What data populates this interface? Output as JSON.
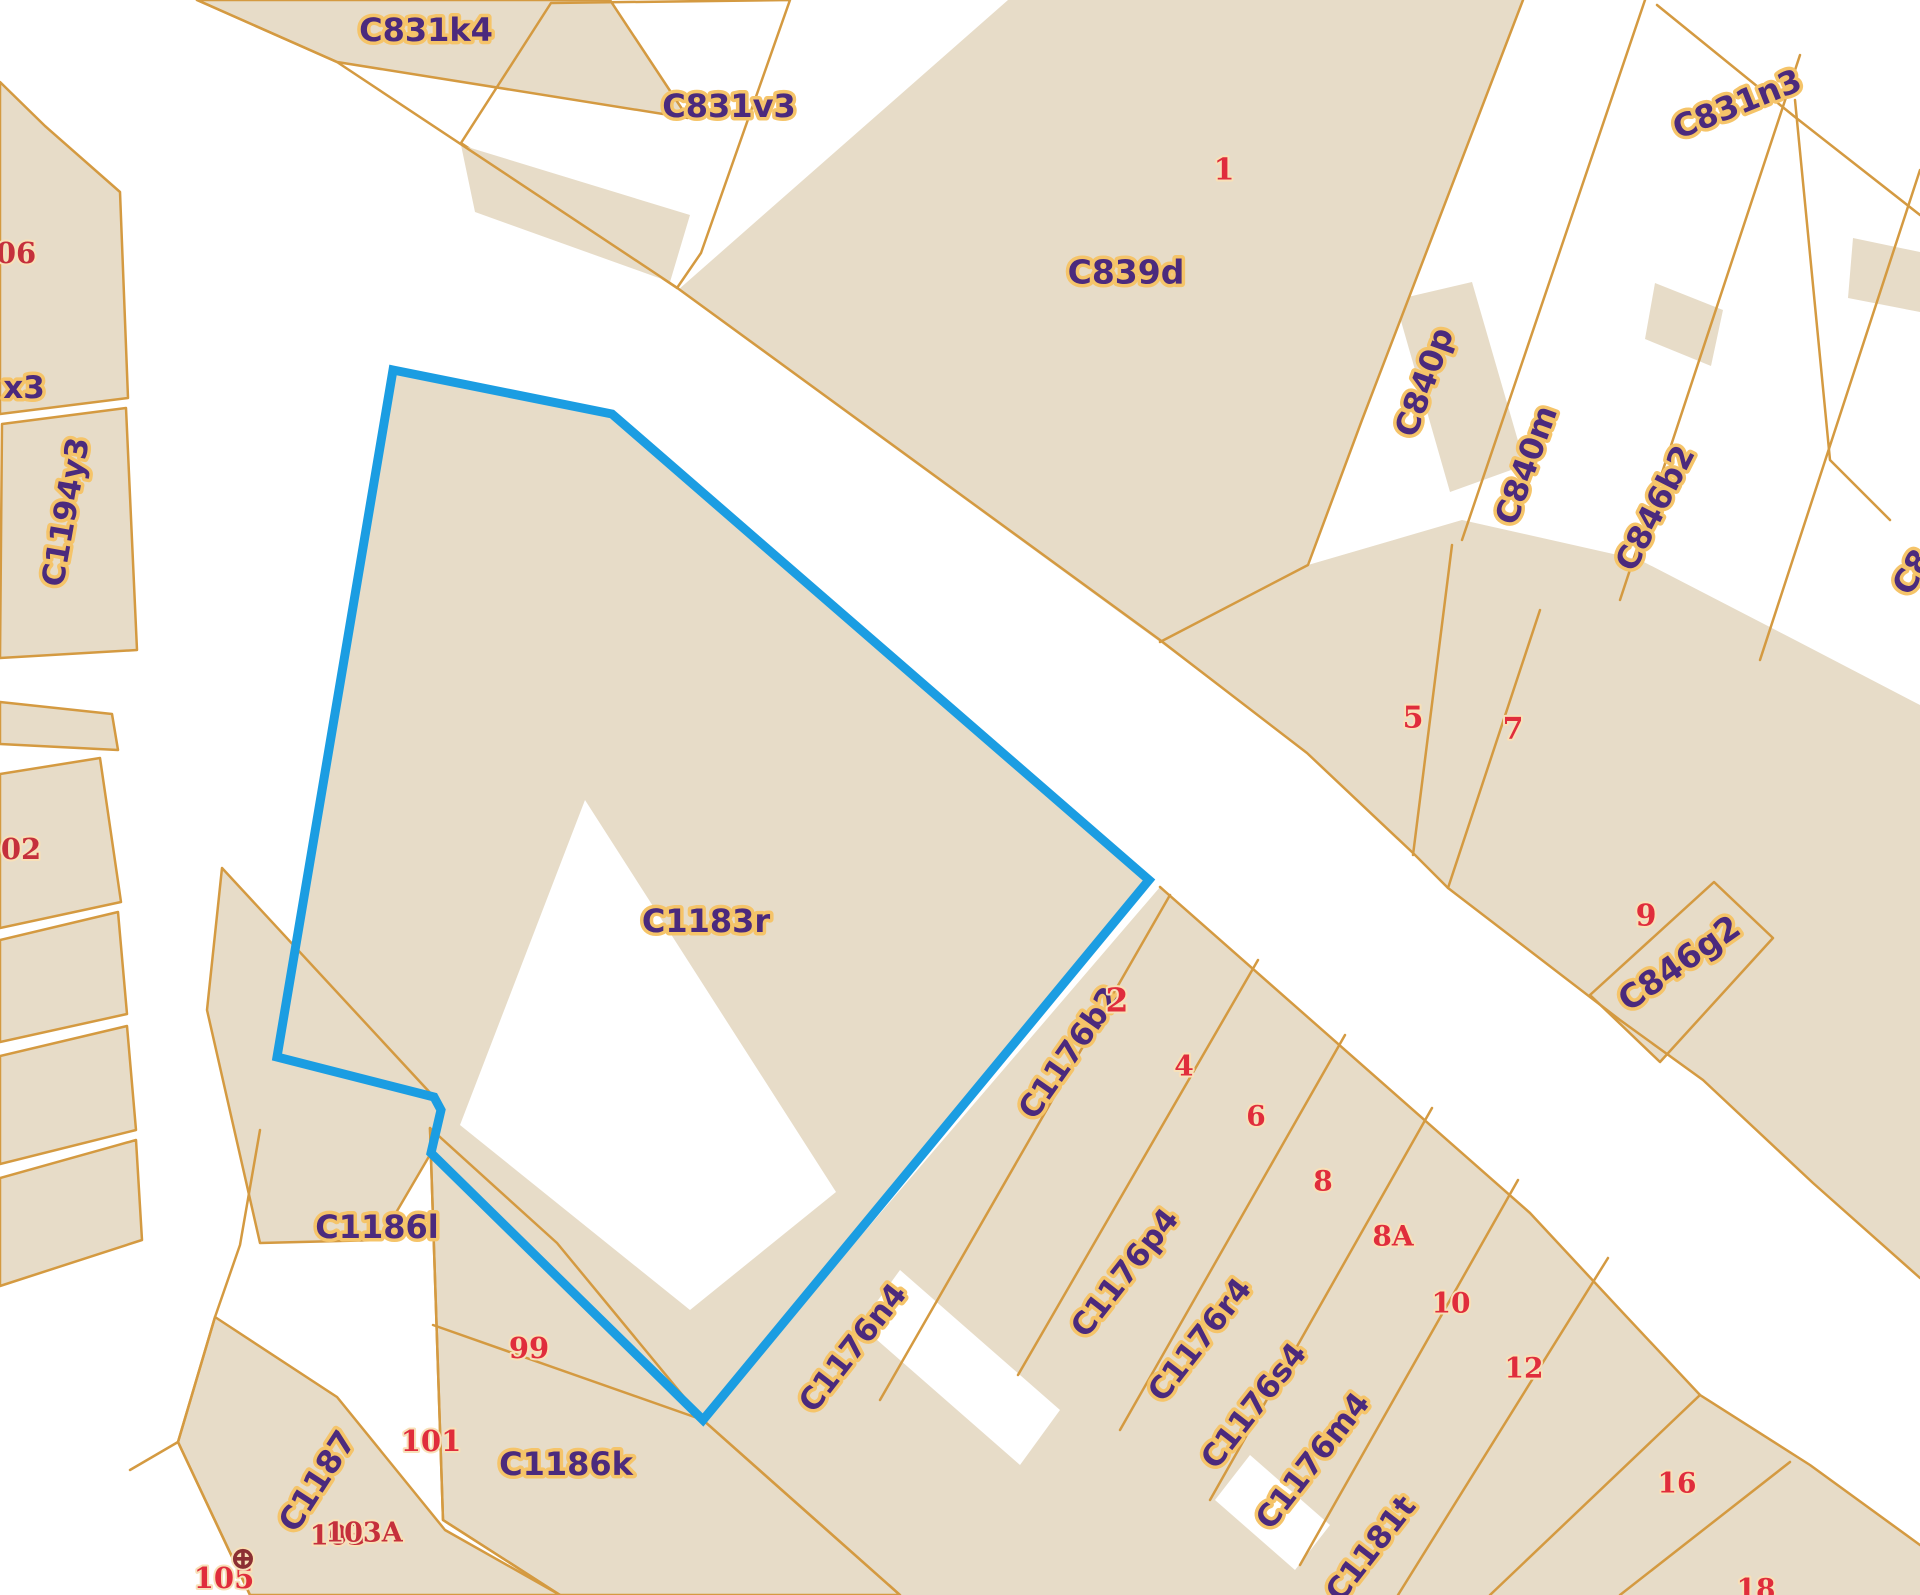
{
  "app": {
    "title": "Cadastral parcel map",
    "selected_parcel": "C1183r"
  },
  "map": {
    "width": 1920,
    "height": 1595,
    "background": "#ffffff",
    "parcel_fill": "#e7dcc8",
    "line_color": "#d49a41",
    "label_color": "#4b2a7d",
    "label_halo": "#f5c469",
    "number_color": "#e02d3c",
    "number_dark": "#c5303c",
    "number_halo": "#f8e0b8",
    "symbol_color": "#8c2f33",
    "selection_color": "#1b9de2",
    "selection": {
      "parcel": "C1183r",
      "points": "393,370 612,414 1149,880 703,1420 431,1153 441,1110 434,1097 277,1057",
      "stroke_width": 9
    },
    "shapes": [
      {
        "name": "parcel-c831k4",
        "pts": "197,0 610,0 688,118 337,62",
        "fill": "parcel",
        "stroke": true
      },
      {
        "name": "parcel-c831v3-outline",
        "pts": "551,3 790,0 701,253 677,288 461,143",
        "fill": "none",
        "stroke": true
      },
      {
        "name": "building-c831v3",
        "pts": "461,145 690,215 670,282 475,212",
        "fill": "parcel",
        "stroke": false
      },
      {
        "name": "parcel-c839d",
        "pts": "1008,0 1523,0 1362,420 1308,565 1160,642 678,290",
        "fill": "parcel",
        "stroke": false
      },
      {
        "name": "building-c840p",
        "pts": "1395,300 1472,282 1525,465 1450,492",
        "fill": "parcel",
        "stroke": false
      },
      {
        "name": "building-c831n3-a",
        "pts": "1655,283 1723,310 1711,366 1645,339",
        "fill": "parcel",
        "stroke": false
      },
      {
        "name": "building-c831n3-b",
        "pts": "1853,238 1920,252 1920,312 1848,298",
        "fill": "parcel",
        "stroke": false
      },
      {
        "name": "parcel-block-5-7-9",
        "pts": "1308,565 1462,520 1640,560 1795,640 1920,705 1920,1278 1813,1183 1703,1080 1620,1020 1448,888 1413,853 1307,753 1160,642",
        "fill": "parcel",
        "stroke": false
      },
      {
        "name": "parcel-c846g2",
        "pts": "1590,995 1714,882 1773,938 1660,1062",
        "fill": "parcel",
        "stroke": true
      },
      {
        "name": "parcel-c1183r-fill",
        "pts": "393,370 612,414 1149,880 703,1420 431,1153 441,1110 434,1097 277,1057",
        "fill": "parcel",
        "stroke": false
      },
      {
        "name": "courtyard-c1183r",
        "pts": "585,800 836,1192 690,1310 460,1125",
        "fill": "white",
        "stroke": false
      },
      {
        "name": "parcel-block-c1176",
        "pts": "1160,887 1530,1213 1625,1315 1700,1395 1810,1465 1920,1545 1920,1595 900,1595 703,1420",
        "fill": "parcel",
        "stroke": false
      },
      {
        "name": "gap-c1176-a",
        "pts": "900,1270 1060,1410 1020,1465 860,1325",
        "fill": "white",
        "stroke": false
      },
      {
        "name": "gap-c1176-b",
        "pts": "1250,1455 1330,1525 1295,1570 1215,1500",
        "fill": "white",
        "stroke": false
      },
      {
        "name": "parcel-c1186l",
        "pts": "222,868 434,1097 441,1112 431,1153 380,1240 260,1243 207,1010",
        "fill": "parcel",
        "stroke": true
      },
      {
        "name": "parcel-block-99-101",
        "pts": "430,1128 557,1243 703,1420 900,1595 560,1595 443,1520",
        "fill": "parcel",
        "stroke": true
      },
      {
        "name": "parcel-c1187-strip",
        "pts": "215,1317 337,1397 445,1530 560,1595 250,1595 178,1442",
        "fill": "parcel",
        "stroke": true
      },
      {
        "name": "parcel-left-06",
        "pts": "0,82 45,126 120,192 128,398 0,414",
        "fill": "parcel",
        "stroke": true
      },
      {
        "name": "parcel-c1194y3",
        "pts": "2,424 126,408 137,650 0,658",
        "fill": "parcel",
        "stroke": true
      },
      {
        "name": "parcel-left-sliver",
        "pts": "0,702 112,714 118,750 0,744",
        "fill": "parcel",
        "stroke": true
      },
      {
        "name": "parcel-left-102",
        "pts": "0,774 100,758 121,902 0,928",
        "fill": "parcel",
        "stroke": true
      },
      {
        "name": "parcel-left-e",
        "pts": "0,940 118,912 127,1014 0,1042",
        "fill": "parcel",
        "stroke": true
      },
      {
        "name": "parcel-left-f",
        "pts": "0,1056 127,1026 136,1130 0,1164",
        "fill": "parcel",
        "stroke": true
      },
      {
        "name": "parcel-left-g",
        "pts": "0,1178 136,1140 142,1240 0,1286",
        "fill": "parcel",
        "stroke": true
      }
    ],
    "lines": [
      {
        "name": "street-north-edge",
        "pts": "197,0 337,62 676,287 1160,640 1307,753 1413,853 1448,888 1620,1020 1703,1080 1813,1183 1920,1278"
      },
      {
        "name": "c839d-east-boundary",
        "pts": "1523,0 1362,420 1308,565 1160,642"
      },
      {
        "name": "strip-line-s2",
        "pts": "1645,0 1462,540"
      },
      {
        "name": "strip-line-s3",
        "pts": "1800,55 1620,600"
      },
      {
        "name": "strip-line-s4",
        "pts": "1920,170 1760,660"
      },
      {
        "name": "c831n3-south-boundary",
        "pts": "1657,5 1795,117 1920,215"
      },
      {
        "name": "right-boundary",
        "pts": "1795,100 1830,460 1890,520"
      },
      {
        "name": "divider-5-7",
        "pts": "1413,855 1452,545"
      },
      {
        "name": "divider-7-9",
        "pts": "1448,888 1540,610"
      },
      {
        "name": "street-sw-edge",
        "pts": "1160,887 1530,1213 1625,1315 1700,1395 1810,1465 1920,1545"
      },
      {
        "name": "strip-t1",
        "pts": "1170,895 880,1400"
      },
      {
        "name": "strip-t2",
        "pts": "1258,960 1018,1375"
      },
      {
        "name": "strip-t3",
        "pts": "1345,1035 1120,1430"
      },
      {
        "name": "strip-t4",
        "pts": "1432,1108 1210,1500"
      },
      {
        "name": "strip-t5",
        "pts": "1518,1180 1300,1565"
      },
      {
        "name": "strip-t6",
        "pts": "1608,1258 1398,1595"
      },
      {
        "name": "strip-t7",
        "pts": "1700,1395 1490,1595"
      },
      {
        "name": "strip-t8",
        "pts": "1790,1462 1620,1595"
      },
      {
        "name": "bottom-street-ne-edge",
        "pts": "703,1420 900,1595"
      },
      {
        "name": "left-street-edge",
        "pts": "260,1130 240,1245 215,1317 178,1442 130,1470"
      },
      {
        "name": "corner-line",
        "pts": "178,1442 250,1595"
      },
      {
        "name": "corridor-east-edge",
        "pts": "430,1128 443,1520 560,1595"
      },
      {
        "name": "divider-99-101",
        "pts": "433,1325 703,1420"
      }
    ],
    "labels": [
      {
        "text": "C831k4",
        "x": 426,
        "y": 30,
        "rot": 0,
        "size": 32,
        "kind": "code"
      },
      {
        "text": "C831v3",
        "x": 729,
        "y": 106,
        "rot": 0,
        "size": 32,
        "kind": "code"
      },
      {
        "text": "C839d",
        "x": 1126,
        "y": 272,
        "rot": 0,
        "size": 33,
        "kind": "code"
      },
      {
        "text": "C831n3",
        "x": 1737,
        "y": 104,
        "rot": -22,
        "size": 32,
        "kind": "code"
      },
      {
        "text": "C840p",
        "x": 1424,
        "y": 382,
        "rot": -70,
        "size": 32,
        "kind": "code"
      },
      {
        "text": "C840m",
        "x": 1526,
        "y": 465,
        "rot": -70,
        "size": 32,
        "kind": "code"
      },
      {
        "text": "C846b2",
        "x": 1655,
        "y": 508,
        "rot": -63,
        "size": 32,
        "kind": "code"
      },
      {
        "text": "C8",
        "x": 1912,
        "y": 572,
        "rot": -60,
        "size": 32,
        "kind": "code"
      },
      {
        "text": "C1194y3",
        "x": 66,
        "y": 512,
        "rot": -80,
        "size": 31,
        "kind": "code"
      },
      {
        "text": "x3",
        "x": 24,
        "y": 388,
        "rot": 0,
        "size": 31,
        "kind": "code"
      },
      {
        "text": "C1183r",
        "x": 706,
        "y": 921,
        "rot": 0,
        "size": 32,
        "kind": "code"
      },
      {
        "text": "C1186l",
        "x": 377,
        "y": 1227,
        "rot": 0,
        "size": 32,
        "kind": "code"
      },
      {
        "text": "C1186k",
        "x": 566,
        "y": 1464,
        "rot": 0,
        "size": 32,
        "kind": "code"
      },
      {
        "text": "C1187",
        "x": 317,
        "y": 1481,
        "rot": -57,
        "size": 32,
        "kind": "code"
      },
      {
        "text": "C846g2",
        "x": 1679,
        "y": 963,
        "rot": -35,
        "size": 33,
        "kind": "code"
      },
      {
        "text": "C1176b2",
        "x": 1070,
        "y": 1053,
        "rot": -55,
        "size": 31,
        "kind": "code"
      },
      {
        "text": "C1176n4",
        "x": 853,
        "y": 1348,
        "rot": -52,
        "size": 31,
        "kind": "code"
      },
      {
        "text": "C1176p4",
        "x": 1125,
        "y": 1273,
        "rot": -52,
        "size": 31,
        "kind": "code"
      },
      {
        "text": "C1176r4",
        "x": 1200,
        "y": 1340,
        "rot": -52,
        "size": 31,
        "kind": "code"
      },
      {
        "text": "C1176s4",
        "x": 1254,
        "y": 1406,
        "rot": -52,
        "size": 31,
        "kind": "code"
      },
      {
        "text": "C1176m4",
        "x": 1313,
        "y": 1461,
        "rot": -52,
        "size": 31,
        "kind": "code"
      },
      {
        "text": "C1181t",
        "x": 1371,
        "y": 1549,
        "rot": -52,
        "size": 31,
        "kind": "code"
      },
      {
        "text": "1",
        "x": 1224,
        "y": 170,
        "rot": 0,
        "size": 30,
        "kind": "num"
      },
      {
        "text": "5",
        "x": 1413,
        "y": 718,
        "rot": 0,
        "size": 30,
        "kind": "num"
      },
      {
        "text": "7",
        "x": 1513,
        "y": 729,
        "rot": 0,
        "size": 30,
        "kind": "num"
      },
      {
        "text": "9",
        "x": 1646,
        "y": 916,
        "rot": 0,
        "size": 30,
        "kind": "num"
      },
      {
        "text": "2",
        "x": 1117,
        "y": 1000,
        "rot": 0,
        "size": 33,
        "kind": "num"
      },
      {
        "text": "4",
        "x": 1184,
        "y": 1066,
        "rot": 0,
        "size": 28,
        "kind": "num"
      },
      {
        "text": "6",
        "x": 1256,
        "y": 1116,
        "rot": 0,
        "size": 28,
        "kind": "num"
      },
      {
        "text": "8",
        "x": 1323,
        "y": 1181,
        "rot": 0,
        "size": 28,
        "kind": "num"
      },
      {
        "text": "8A",
        "x": 1393,
        "y": 1236,
        "rot": 0,
        "size": 28,
        "kind": "num"
      },
      {
        "text": "10",
        "x": 1451,
        "y": 1303,
        "rot": 0,
        "size": 28,
        "kind": "num"
      },
      {
        "text": "12",
        "x": 1524,
        "y": 1368,
        "rot": 0,
        "size": 28,
        "kind": "num"
      },
      {
        "text": "16",
        "x": 1677,
        "y": 1483,
        "rot": 0,
        "size": 28,
        "kind": "num"
      },
      {
        "text": "18",
        "x": 1756,
        "y": 1589,
        "rot": 0,
        "size": 28,
        "kind": "num"
      },
      {
        "text": "99",
        "x": 529,
        "y": 1348,
        "rot": 0,
        "size": 29,
        "kind": "num"
      },
      {
        "text": "101",
        "x": 431,
        "y": 1441,
        "rot": 0,
        "size": 29,
        "kind": "num"
      },
      {
        "text": "103",
        "x": 338,
        "y": 1536,
        "rot": 0,
        "size": 27,
        "kind": "numdark"
      },
      {
        "text": "103A",
        "x": 364,
        "y": 1533,
        "rot": 0,
        "size": 27,
        "kind": "numdark"
      },
      {
        "text": "105",
        "x": 224,
        "y": 1578,
        "rot": 0,
        "size": 29,
        "kind": "num"
      },
      {
        "text": "06",
        "x": 16,
        "y": 253,
        "rot": 0,
        "size": 29,
        "kind": "numdark"
      },
      {
        "text": "02",
        "x": 21,
        "y": 849,
        "rot": 0,
        "size": 29,
        "kind": "numdark"
      },
      {
        "text": "⊕",
        "x": 243,
        "y": 1558,
        "rot": 0,
        "size": 32,
        "kind": "sym"
      }
    ]
  }
}
